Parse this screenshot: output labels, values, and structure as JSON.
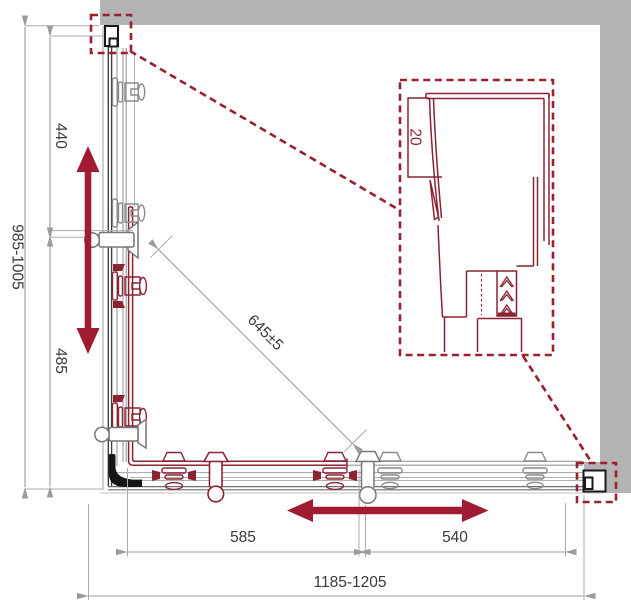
{
  "drawing": {
    "type": "shower-enclosure-corner-dimension-drawing",
    "dimensions": {
      "height_range": "985-1005",
      "upper_panel": "440",
      "lower_panel": "485",
      "diagonal_entry": "645±5",
      "door_width": "585",
      "fixed_width": "540",
      "width_range": "1185-1205",
      "profile_detail": "20"
    },
    "colors": {
      "accent_red": "#9E1B32",
      "line_red": "#8B2332",
      "callout_red": "#9A2030",
      "wall_gray": "#B3B3B3",
      "dimension_gray": "#9C9C9C",
      "text_gray": "#3A3A3A",
      "bracket_black": "#1A1A1A"
    },
    "symbols": {
      "vertical_slide_arrow": "double-headed-arrow-vertical",
      "horizontal_slide_arrow": "double-headed-arrow-horizontal",
      "detail_callouts": "dashed-zoom-boxes-with-leader-lines"
    }
  }
}
